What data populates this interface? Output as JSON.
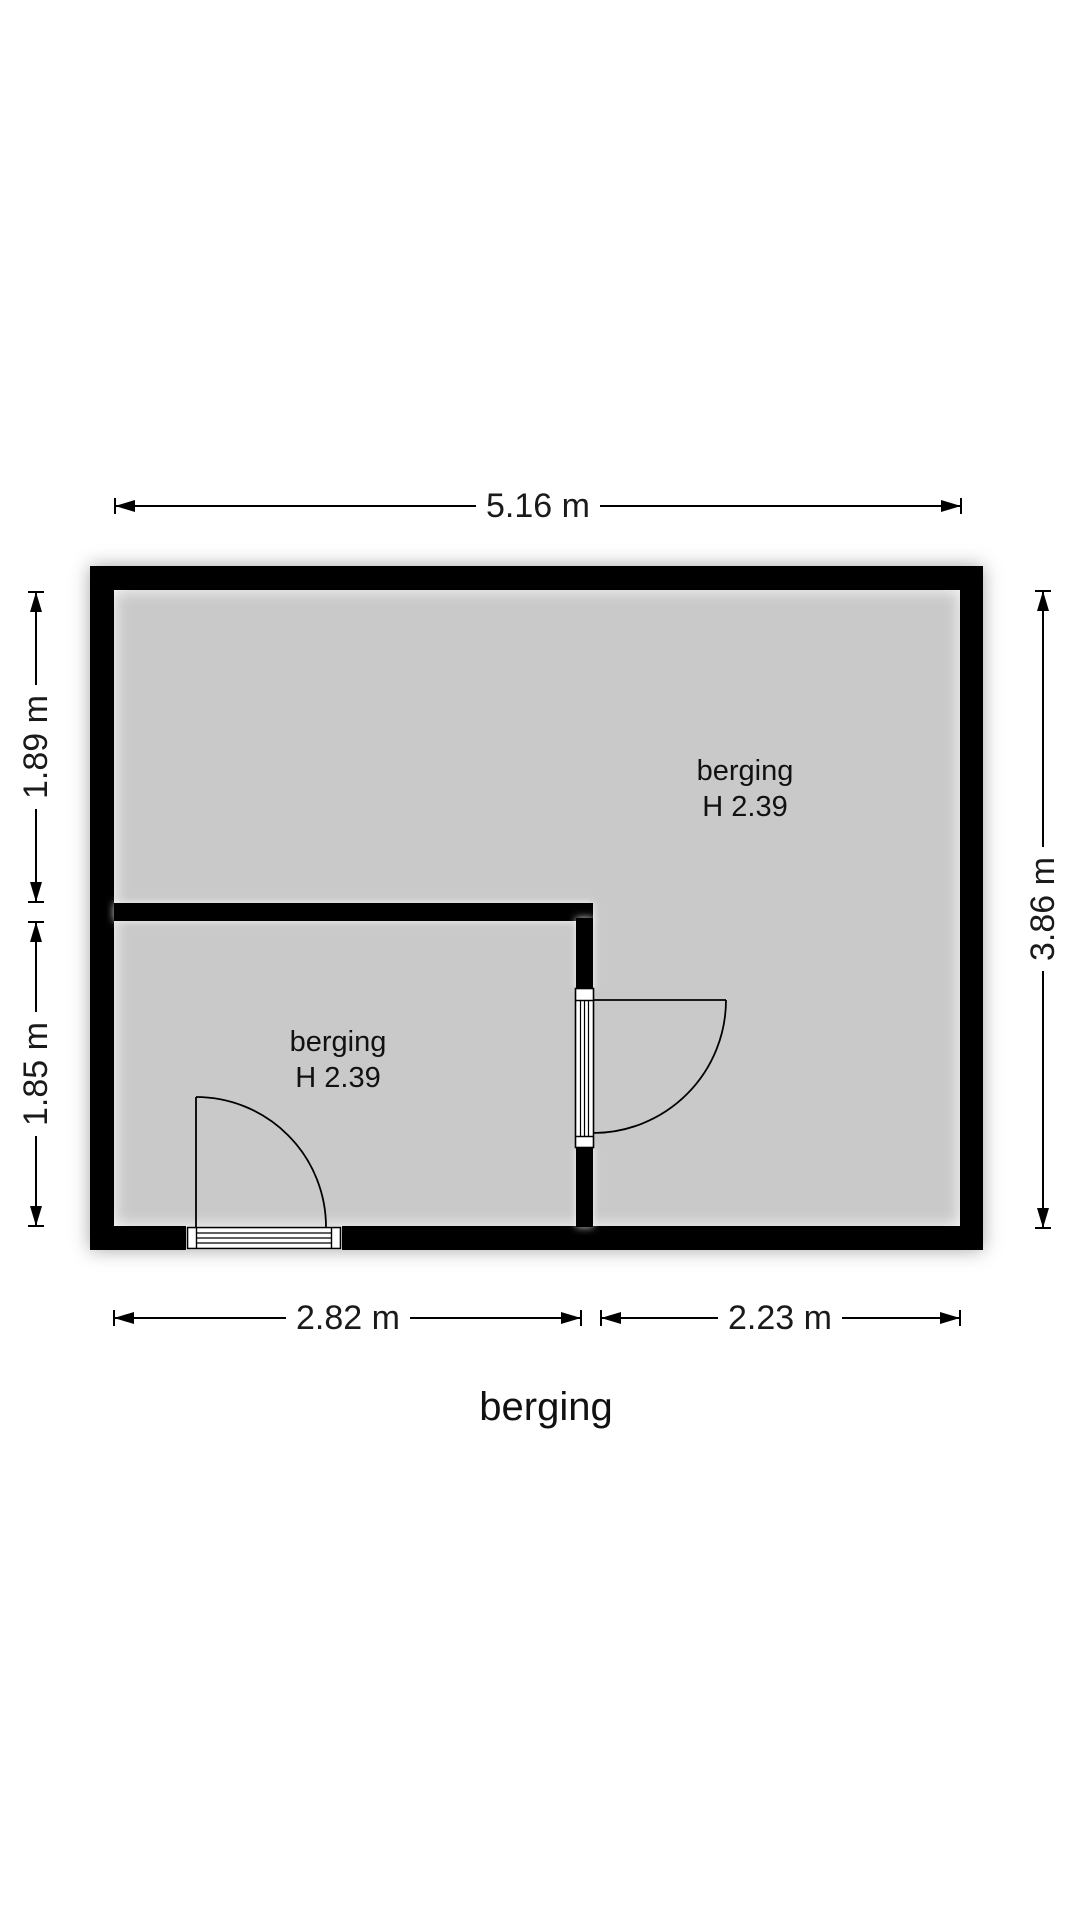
{
  "title": "berging",
  "rooms": {
    "upper": {
      "name": "berging",
      "height": "H 2.39"
    },
    "lower": {
      "name": "berging",
      "height": "H 2.39"
    }
  },
  "dimensions": {
    "width_total": "5.16 m",
    "left_upper": "1.89 m",
    "left_lower": "1.85 m",
    "right_total": "3.86 m",
    "bottom_left": "2.82 m",
    "bottom_right": "2.23 m"
  },
  "colors": {
    "wall": "#000000",
    "floor": "#c9c9c9",
    "background": "#ffffff",
    "line": "#000000"
  }
}
